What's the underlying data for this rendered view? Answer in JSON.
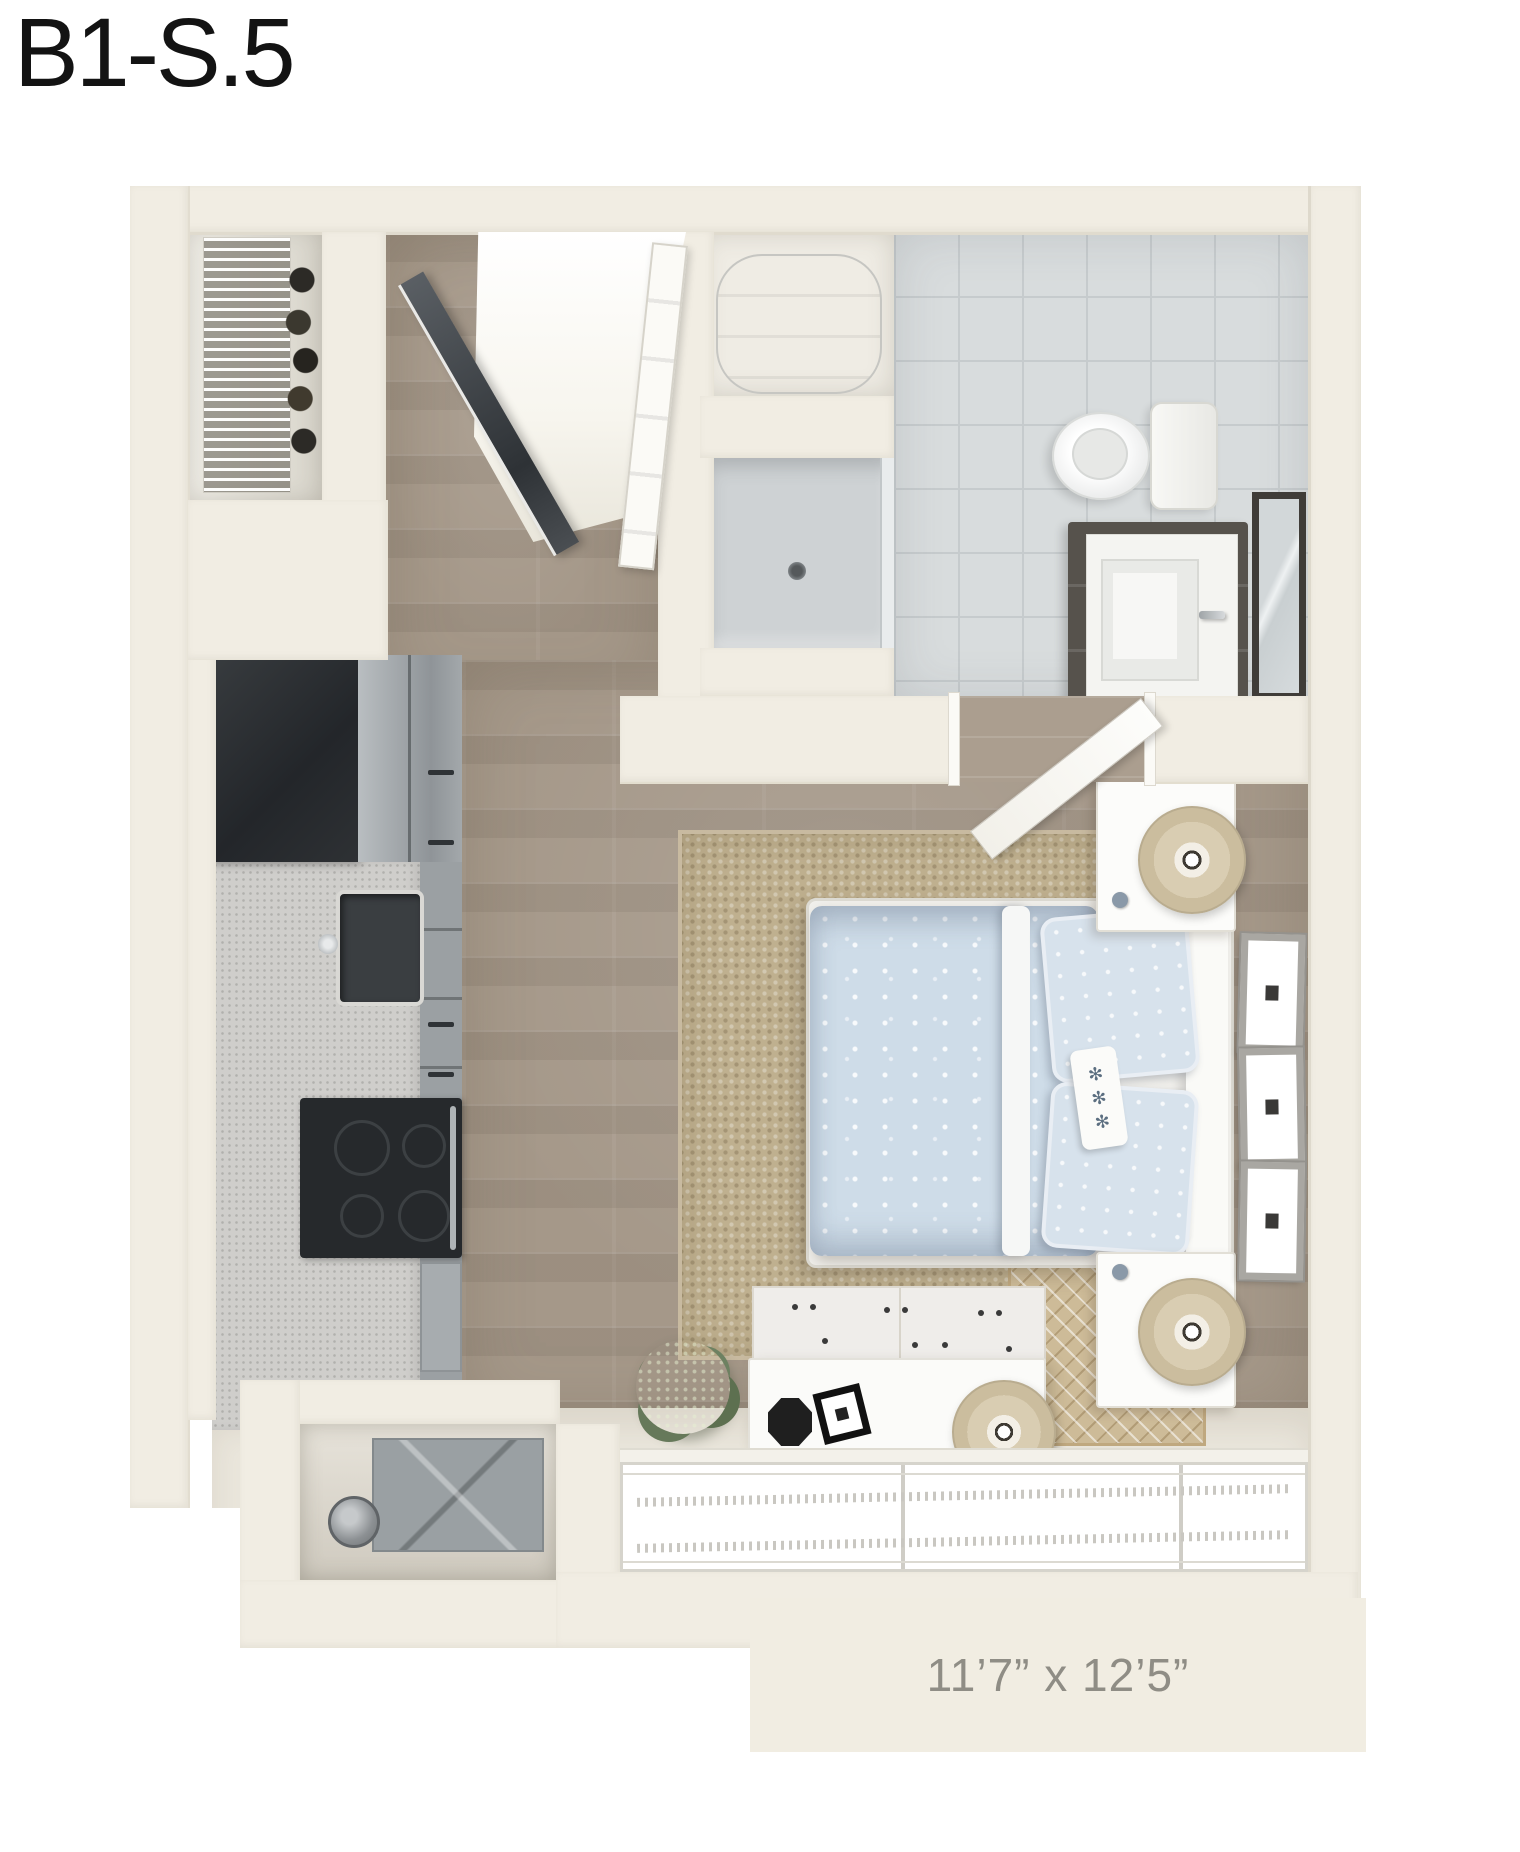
{
  "title": "B1-S.5",
  "floor_plan": {
    "dimensions_label": "11’7” x 12’5”",
    "view": "3d-top-down-floor-plan",
    "unit_type": "studio",
    "rooms": [
      "entry",
      "coat-closet",
      "bathroom",
      "kitchen",
      "living-sleeping-area",
      "mechanical-closet"
    ],
    "fixtures": [
      "wire-shelf-closet",
      "entry-door",
      "mirrored-closet-door",
      "water-heater",
      "shower",
      "toilet",
      "vanity-sink",
      "bath-mirror",
      "refrigerator",
      "kitchen-sink",
      "range",
      "bed",
      "nightstand",
      "table-lamp",
      "jute-area-rug",
      "accent-rug",
      "wall-frames",
      "dresser",
      "potted-plant",
      "windows",
      "hvac-unit"
    ],
    "colors": {
      "wall": "#f1ede3",
      "wood_floor": "#a59889",
      "tile_floor": "#d8dcdd",
      "rug_jute": "#bfb08f",
      "bedding_blue": "#cedce8",
      "cabinet_gray": "#9ba0a3",
      "appliance_dark": "#26292c",
      "dimension_text": "#8f8d85",
      "title_text": "#131313"
    }
  }
}
